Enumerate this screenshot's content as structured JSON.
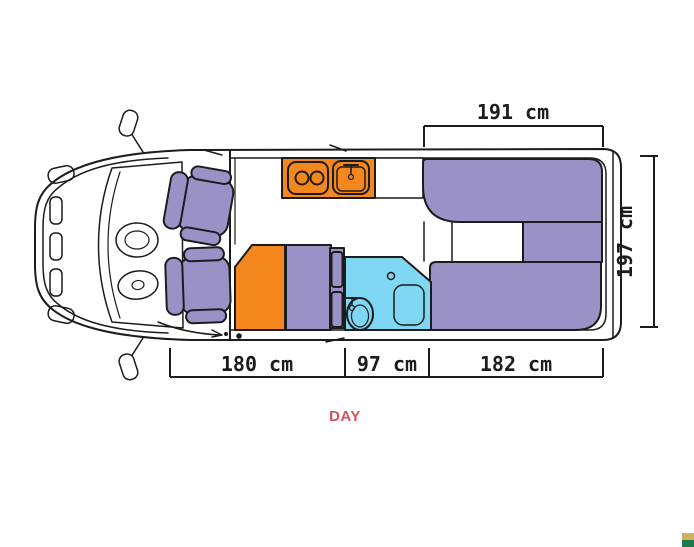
{
  "figure": {
    "type": "camper-van-floorplan-top-view",
    "mode_label": "DAY",
    "dimensions": {
      "rear_bed_width": "191 cm",
      "interior_width": "197 cm",
      "front_section": "180 cm",
      "bathroom_section": "97 cm",
      "rear_section": "182 cm"
    }
  },
  "colors": {
    "line": "#1c1c1c",
    "furniture": "#9a92c7",
    "kitchen": "#f5871f",
    "bathroom": "#7fd7f3",
    "day": "#d9505a",
    "logo-top": "#cdb266",
    "logo-bottom": "#1f7a4b"
  }
}
